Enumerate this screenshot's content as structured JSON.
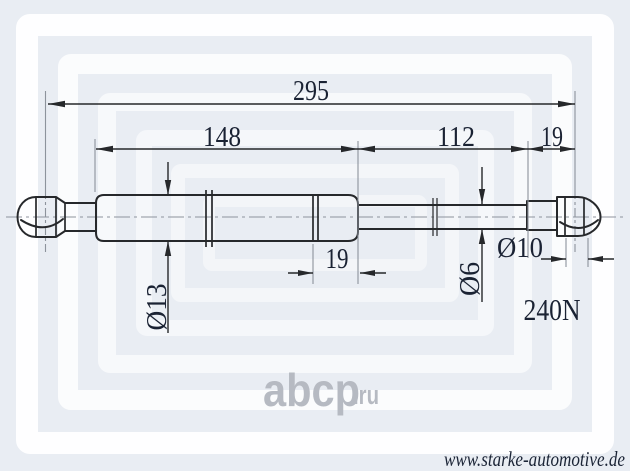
{
  "drawing": {
    "dims": {
      "overall": "295",
      "body": "148",
      "rod": "112",
      "end_fitting": "19",
      "piston_section": "19"
    },
    "diameters": {
      "body": "Ø13",
      "rod": "Ø6",
      "eye": "Ø10"
    },
    "force": "240N"
  },
  "watermark": {
    "brand": "abcp",
    "tld": ".ru"
  },
  "footer": {
    "url": "www.starke-automotive.de"
  },
  "colors": {
    "background": "#e9edf3",
    "watermark_white": "#ffffff",
    "outline": "#26282b",
    "dim_text": "#1a2233",
    "support_line": "#8d939c",
    "watermark_text": "#b6bac2",
    "footer_text": "#1b2436"
  }
}
